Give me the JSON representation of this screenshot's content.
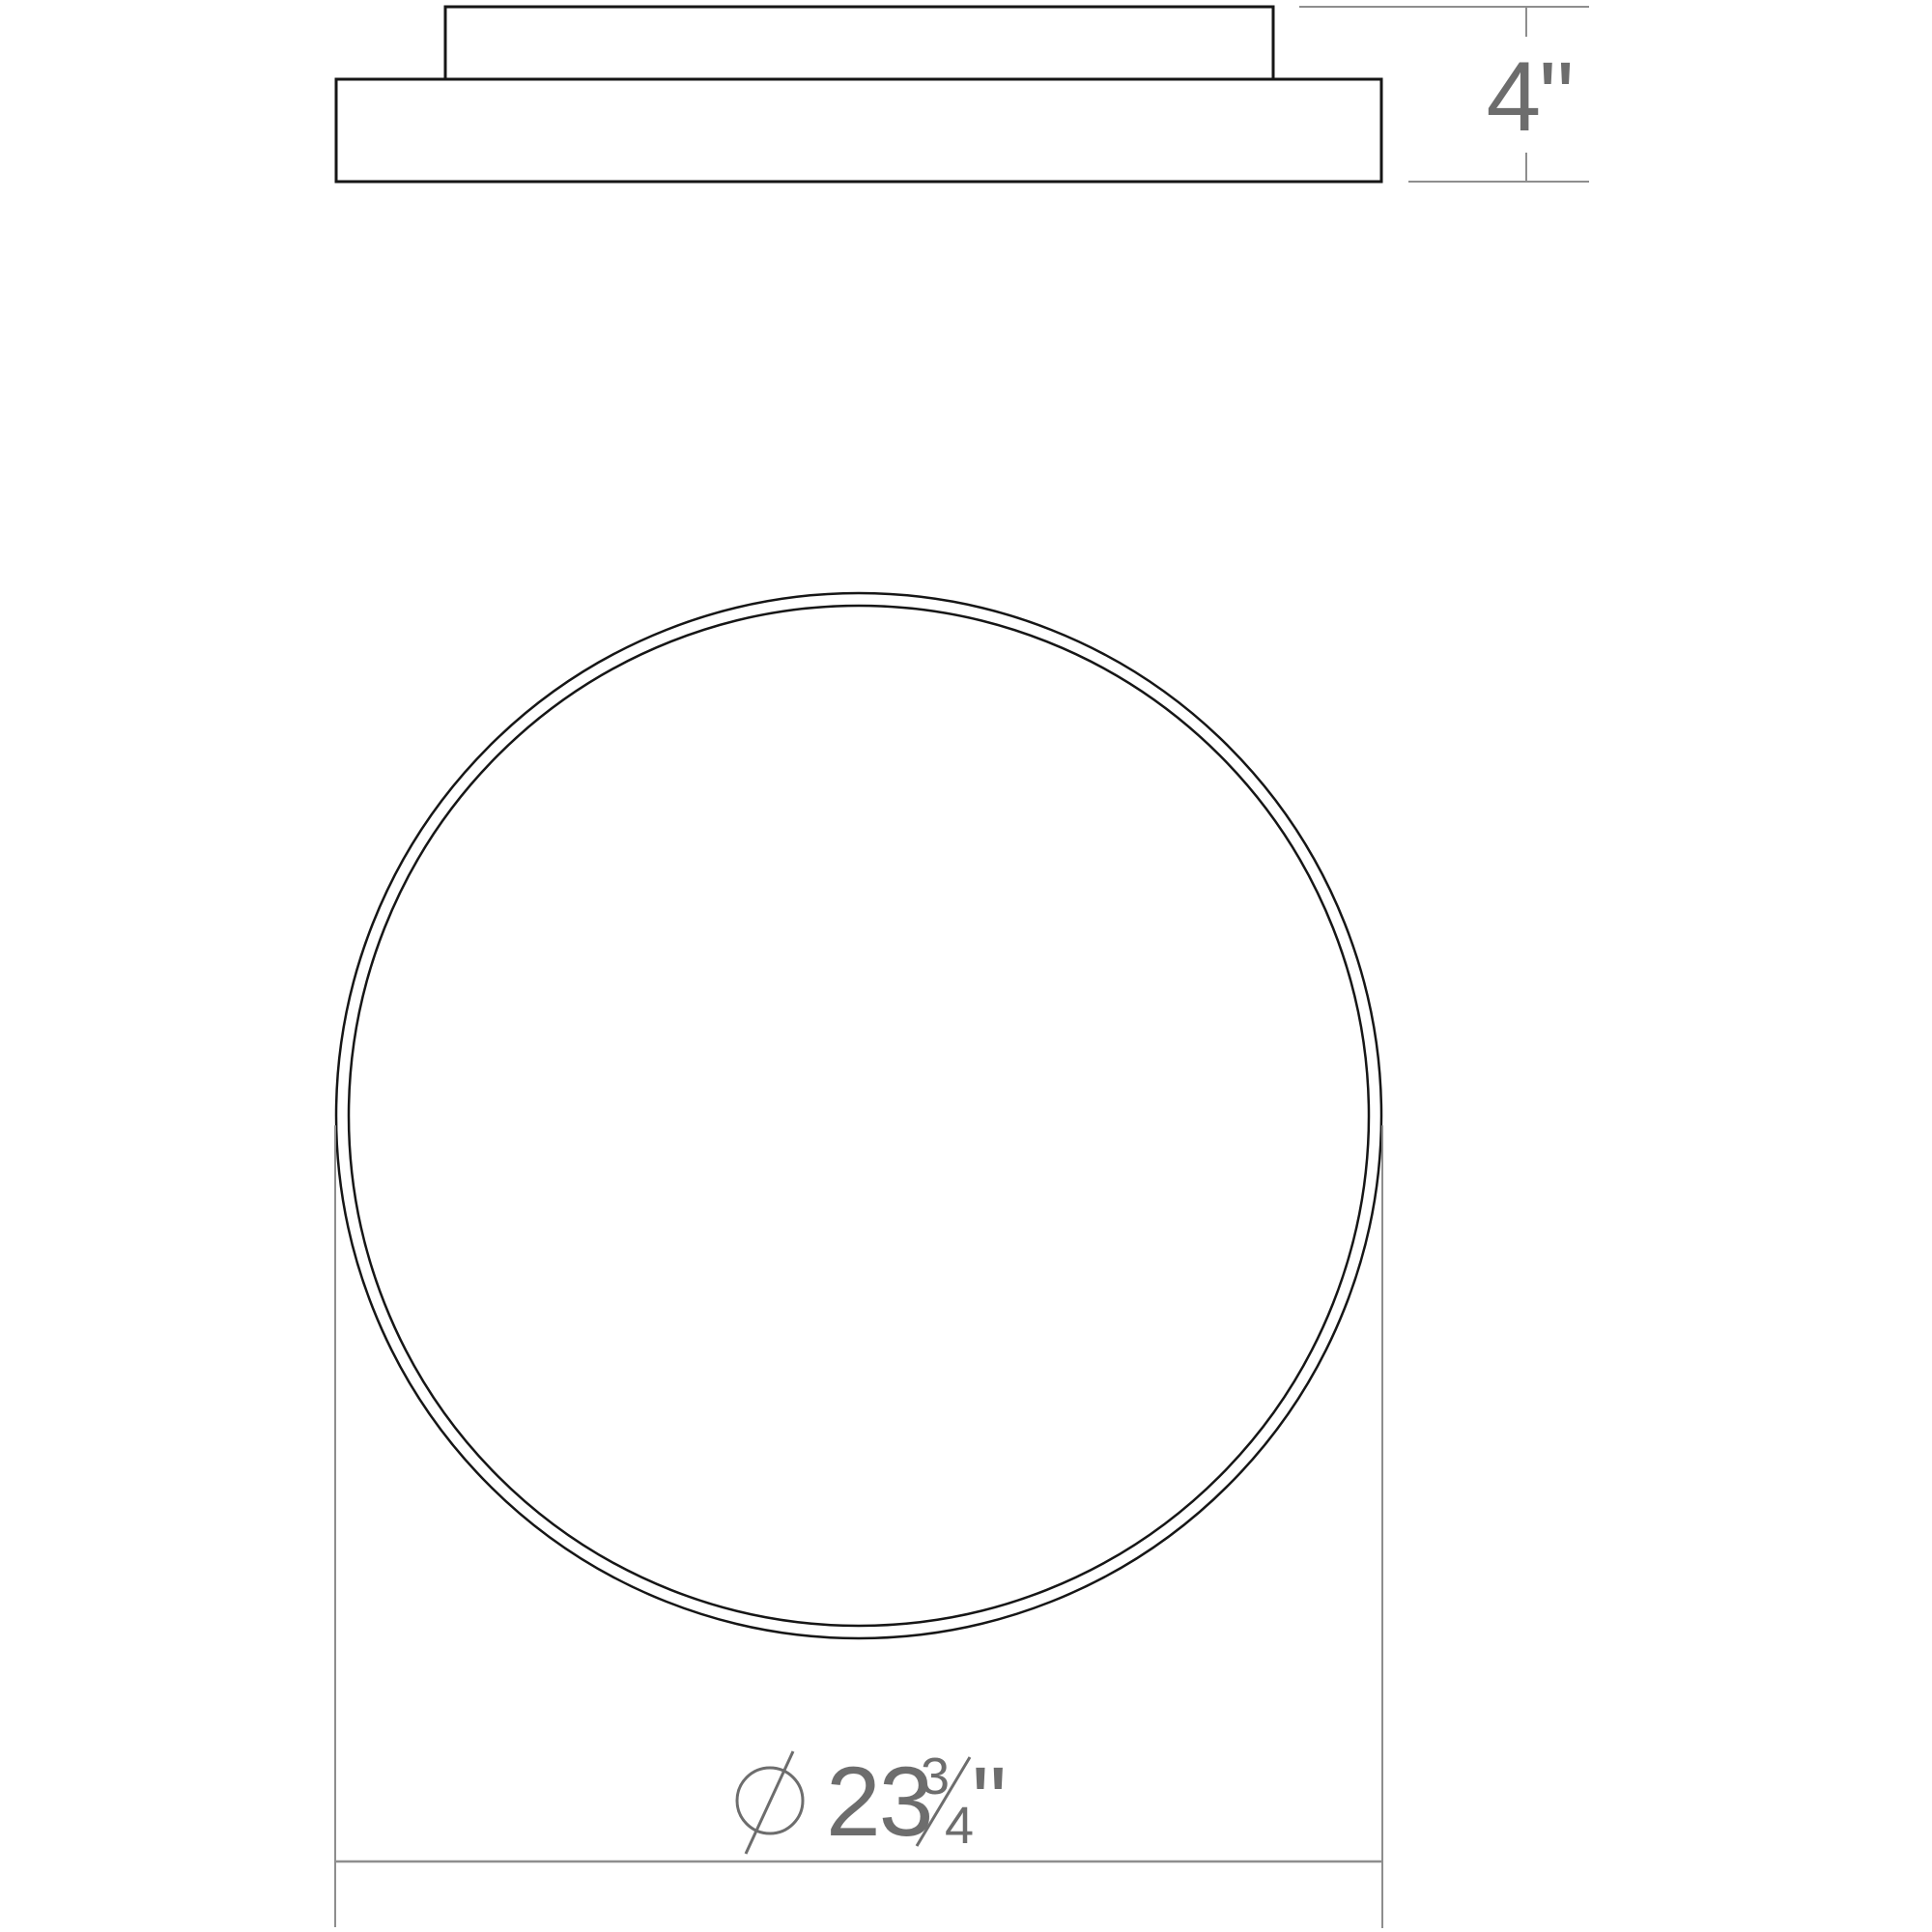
{
  "drawing": {
    "type": "technical-dimension-diagram",
    "subject": "round flush-mount ceiling light fixture",
    "background_color": "#ffffff",
    "colors": {
      "outline": "#161616",
      "dimension_line": "#8e8e8e",
      "dimension_text": "#6d6d6d"
    },
    "side_view": {
      "description": "side profile: mounting canopy above wider fixture body",
      "height_dimension": {
        "text": "4\""
      }
    },
    "front_view": {
      "description": "front view: double-outlined circle of fixture face",
      "diameter_dimension": {
        "symbol": "diameter-icon",
        "whole": "23",
        "numerator": "3",
        "denominator": "4",
        "inches_mark": "\"",
        "full_value": "⌀ 23 3/4\""
      }
    }
  }
}
